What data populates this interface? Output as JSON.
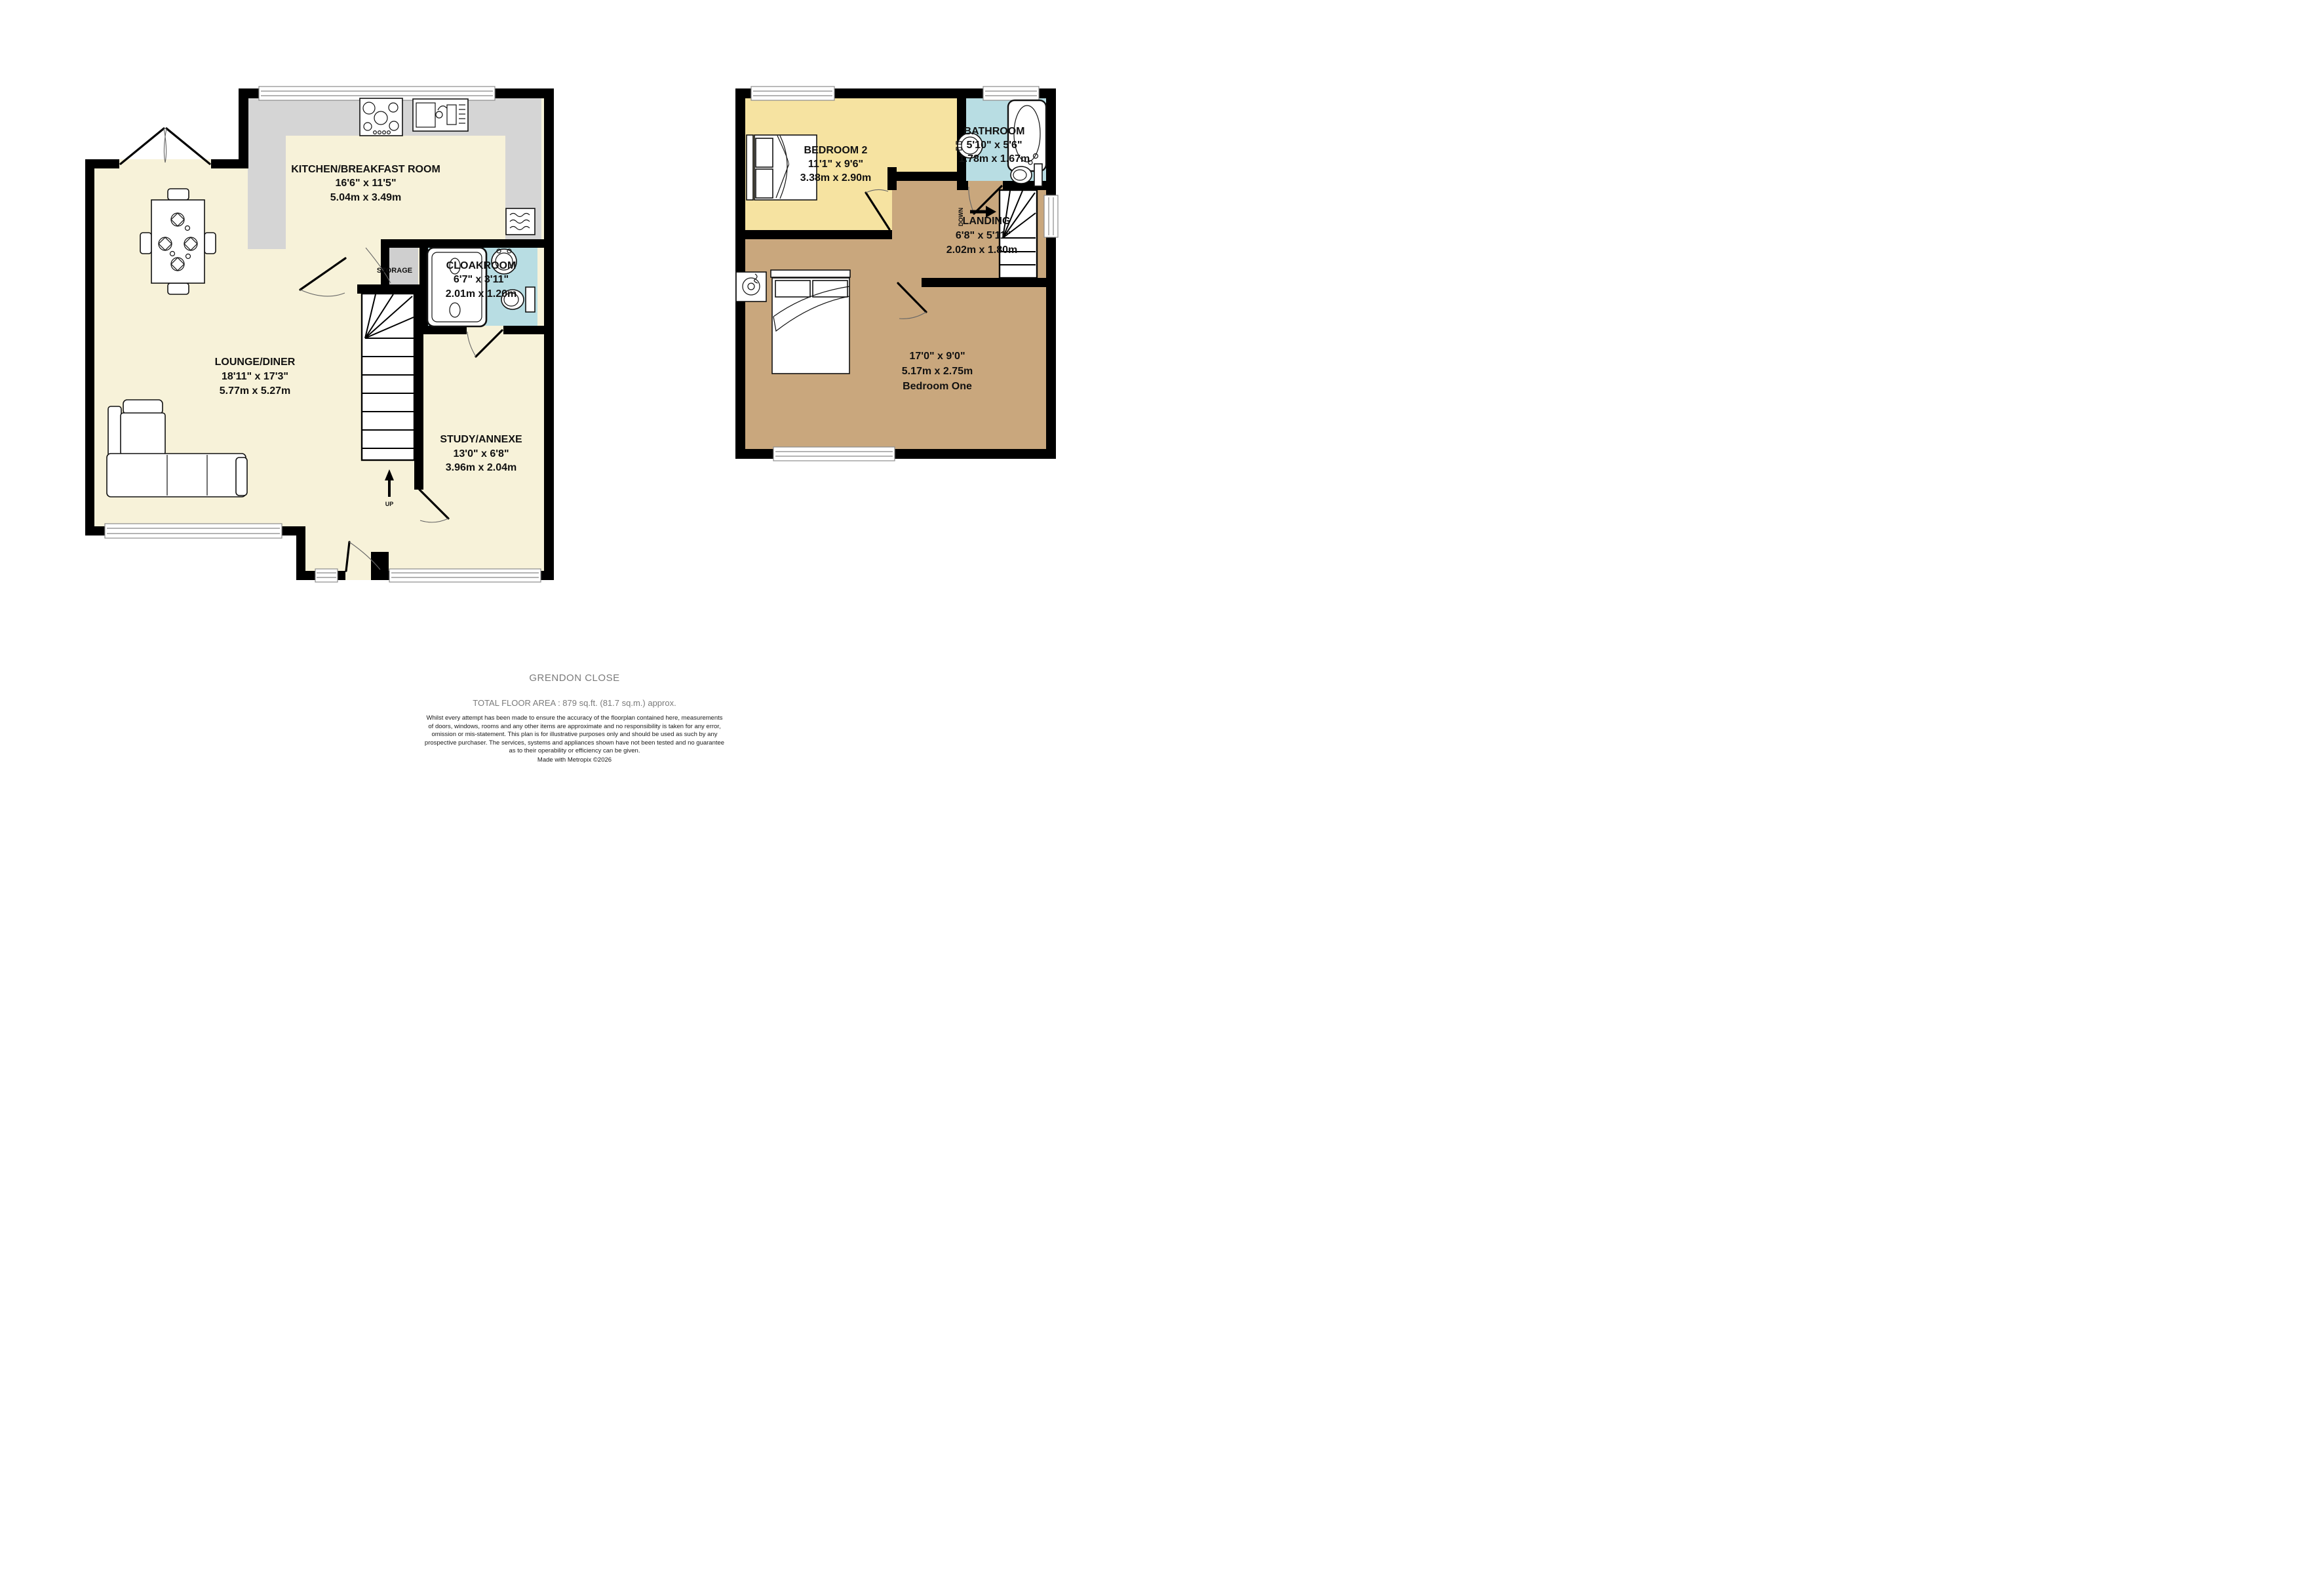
{
  "rooms": {
    "kitchen": {
      "name": "KITCHEN/BREAKFAST ROOM",
      "imperial": "16'6\" x 11'5\"",
      "metric": "5.04m x 3.49m"
    },
    "lounge": {
      "name": "LOUNGE/DINER",
      "imperial": "18'11\" x 17'3\"",
      "metric": "5.77m x 5.27m"
    },
    "cloakroom": {
      "name": "CLOAKROOM",
      "imperial": "6'7\" x 3'11\"",
      "metric": "2.01m x 1.20m"
    },
    "study": {
      "name": "STUDY/ANNEXE",
      "imperial": "13'0\" x 6'8\"",
      "metric": "3.96m x 2.04m"
    },
    "bedroom2": {
      "name": "BEDROOM 2",
      "imperial": "11'1\" x 9'6\"",
      "metric": "3.38m x 2.90m"
    },
    "bathroom": {
      "name": "BATHROOM",
      "imperial": "5'10\" x 5'6\"",
      "metric": "1.78m x 1.67m"
    },
    "landing": {
      "name": "LANDING",
      "imperial": "6'8\" x 5'11\"",
      "metric": "2.02m x 1.80m"
    },
    "bedroom1": {
      "name": "Bedroom One",
      "imperial": "17'0\" x 9'0\"",
      "metric": "5.17m x 2.75m"
    }
  },
  "annotations": {
    "storage": "STORAGE",
    "up": "UP",
    "down": "DOWN"
  },
  "footer": {
    "title": "GRENDON CLOSE",
    "total_area": "TOTAL FLOOR AREA : 879 sq.ft. (81.7 sq.m.) approx.",
    "disclaimer_lines": [
      "Whilst every attempt has been made to ensure the accuracy of the floorplan contained here, measurements",
      "of doors, windows, rooms and any other items are approximate and no responsibility is taken for any error,",
      "omission or mis-statement. This plan is for illustrative purposes only and should be used as such by any",
      "prospective purchaser. The services, systems and appliances shown have not been tested and no guarantee",
      "as to their operability or efficiency can be given."
    ],
    "credit": "Made with Metropix ©2026"
  },
  "colors": {
    "floor_cream": "#f7f2d9",
    "bedroom_yellow": "#f6e3a1",
    "bath_blue": "#b8dde3",
    "master_tan": "#c9a77d",
    "counter_gray": "#d5d5d5",
    "wall_black": "#000000",
    "footer_gray": "#7b7b7b"
  }
}
